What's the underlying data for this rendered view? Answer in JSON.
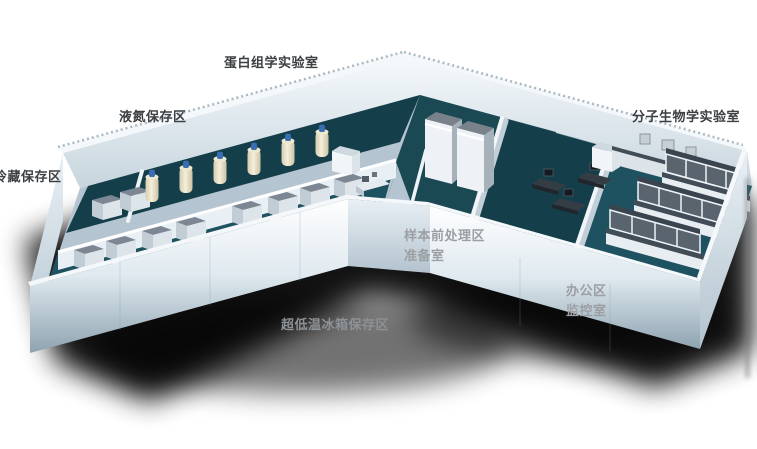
{
  "scene": {
    "kind": "3d-isometric-lab-floorplan"
  },
  "labels": {
    "proteomics_lab": {
      "text": "蛋白组学实验室"
    },
    "liquid_nitrogen_area": {
      "text": "液氮保存区"
    },
    "cold_storage_area": {
      "text": "冷藏保存区"
    },
    "molecular_biology_lab": {
      "text": "分子生物学实验室"
    },
    "sample_pretreatment_area": {
      "text": "样本前处理区"
    },
    "preparation_room": {
      "text": "准备室"
    },
    "office_area": {
      "text": "办公区"
    },
    "monitoring_room": {
      "text": "监控室"
    },
    "ultralow_freezer_area": {
      "text": "超低温冰箱保存区"
    }
  },
  "colors": {
    "floor_teal": "#1a4954",
    "floor_teal_dark": "#143f4a",
    "floor_teal_light": "#1f5260",
    "floor_light": "#b4c5d1",
    "wall_white": "#f4f8fb",
    "wall_shade": "#90a5b2",
    "label_dark": "#3c4043",
    "label_light": "#9b9fa3",
    "label_mid": "#8d9296",
    "dewar_cap": "#3a6db2",
    "freezer_top": "#7c8793",
    "bench_top": "#424c56",
    "cabinet_dark": "#59646f",
    "shadow": "#000000"
  }
}
